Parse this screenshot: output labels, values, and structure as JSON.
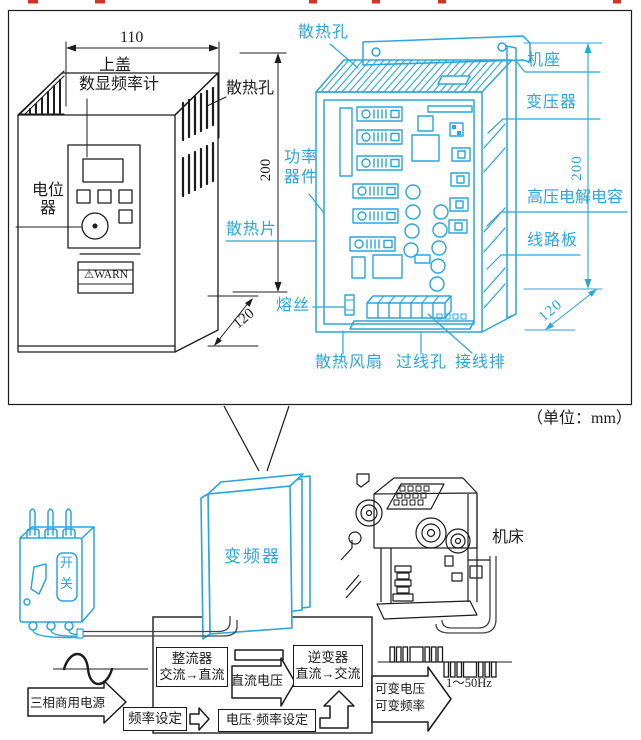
{
  "unit_note": "（单位：mm）",
  "colors": {
    "accent_cyan": "#29a6dd",
    "ink_black": "#1c1c1c",
    "mark_red": "#d93025"
  },
  "outline_view": {
    "dim_width": "110",
    "dim_height": "200",
    "dim_depth": "120",
    "top_cover": "上盖",
    "digital_freq_meter": "数显频率计",
    "vent_holes": "散热孔",
    "potentiometer_line1": "电位",
    "potentiometer_line2": "器",
    "warn_plate": "⚠WARN"
  },
  "internal_view": {
    "dim_height": "200",
    "dim_depth": "120",
    "vent_holes": "散热孔",
    "chassis": "机座",
    "transformer": "变压器",
    "power_devices_line1": "功率",
    "power_devices_line2": "器件",
    "heatsink": "散热片",
    "hv_electrolytic_capacitor": "高压电解电容",
    "circuit_board": "线路板",
    "fuse": "熔丝",
    "cooling_fan": "散热风扇",
    "wire_hole": "过线孔",
    "terminal_block": "接线排"
  },
  "schematic": {
    "switch_line1": "开",
    "switch_line2": "关",
    "three_phase_source": "三相商用电源",
    "inverter_unit": "变频器",
    "machine_tool": "机床",
    "rectifier_line1": "整流器",
    "rectifier_line2": "交流→直流",
    "dc_voltage": "直流电压",
    "inverter_line1": "逆变器",
    "inverter_line2": "直流→交流",
    "freq_setting": "频率设定",
    "vf_setting": "电压·频率设定",
    "variable_line1": "可变电压",
    "variable_line2": "可变频率",
    "freq_range": "1～50Hz"
  }
}
